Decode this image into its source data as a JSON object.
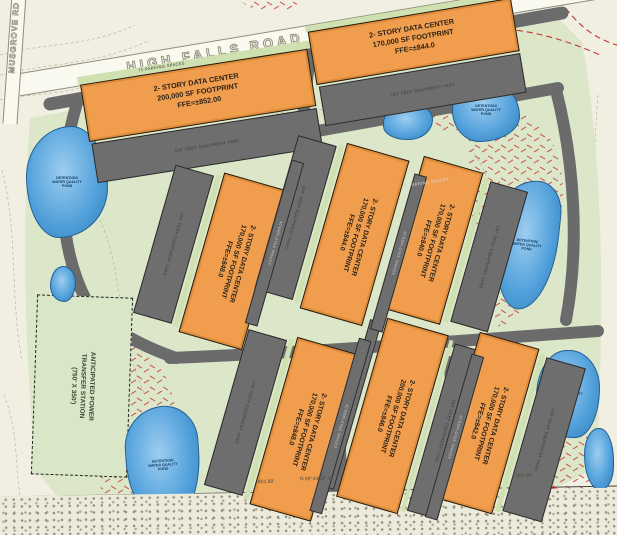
{
  "site": {
    "roads": {
      "high_falls": "HIGH FALLS ROAD",
      "musgrove": "MUSGROVE RD"
    },
    "buildings": [
      {
        "id": "top-left",
        "line1": "2- STORY DATA CENTER",
        "line2": "200,000 SF FOOTPRINT",
        "line3": "FFE=±852.00"
      },
      {
        "id": "top-right",
        "line1": "2- STORY DATA CENTER",
        "line2": "170,000 SF FOOTPRINT",
        "line3": "FFE=±844.0"
      },
      {
        "id": "mid-left",
        "line1": "2- STORY DATA CENTER",
        "line2": "170,000 SF FOOTPRINT",
        "line3": "FFE=±848.0"
      },
      {
        "id": "mid-center",
        "line1": "2- STORY DATA CENTER",
        "line2": "170,000 SF FOOTPRINT",
        "line3": "FFE=±844.0"
      },
      {
        "id": "mid-right",
        "line1": "2- STORY DATA CENTER",
        "line2": "170,000 SF FOOTPRINT",
        "line3": "FFE=±840.0"
      },
      {
        "id": "bottom-left",
        "line1": "2- STORY DATA CENTER",
        "line2": "170,000 SF FOOTPRINT",
        "line3": "FFE=±848.0"
      },
      {
        "id": "bottom-center",
        "line1": "2- STORY DATA CENTER",
        "line2": "200,000 SF FOOTPRINT",
        "line3": "FFE=±846.0"
      },
      {
        "id": "bottom-right",
        "line1": "2- STORY DATA CENTER",
        "line2": "170,000 SF FOOTPRINT",
        "line3": "FFE=±842.0"
      }
    ],
    "power_station": {
      "line1": "ANTICIPATED POWER",
      "line2": "TRANSFER STATION",
      "line3": "(750' X 350')"
    },
    "pond_label": [
      "DETENTION/",
      "WATER QUALITY",
      "POND"
    ],
    "equipment_yard_label": "100' DEEP EQUIPMENT YARD",
    "parking_label_top": "75 PARKING SPACES",
    "parking_label_mid": "48 PARKING SPACES",
    "employee_spaces_label": "40 EMPLOYEE SPACES",
    "survey": {
      "dist1": "801.69'",
      "bearing": "N 89°44'54\" W",
      "dist2": "900.00'"
    },
    "colors": {
      "building_orange": "#f09e4e",
      "road_gray": "#6b6b6b",
      "pond_blue": "#55a3dc",
      "site_green": "#dce7c9",
      "slope_hatch_red": "#c94040"
    }
  }
}
